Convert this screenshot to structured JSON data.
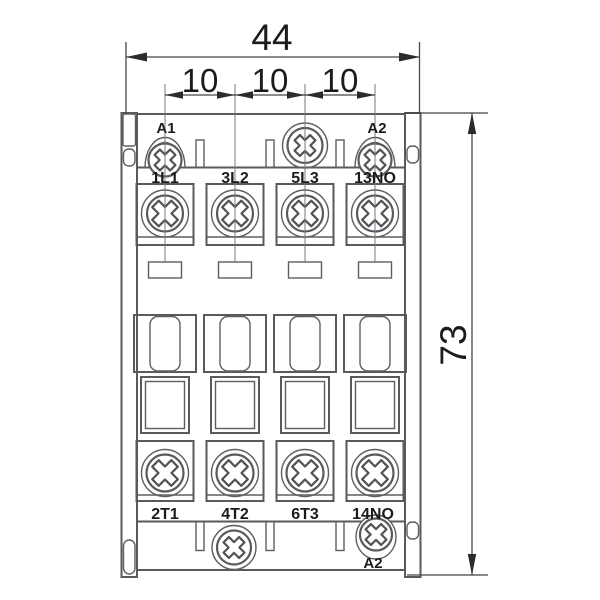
{
  "dimensions": {
    "total_width": "44",
    "pole_pitch": [
      "10",
      "10",
      "10"
    ],
    "total_height": "73"
  },
  "coil_labels": {
    "top_left": "A1",
    "top_right": "A2",
    "bottom_right": "A2"
  },
  "terminal_labels": {
    "top_row": [
      "1L1",
      "3L2",
      "5L3",
      "13NO"
    ],
    "bottom_row": [
      "2T1",
      "4T2",
      "6T3",
      "14NO"
    ]
  },
  "colors": {
    "background": "#ffffff",
    "body_line": "#595a5e",
    "dimension_line": "#46464a",
    "arrow_fill": "#2c2c2e",
    "label_text": "#1b1b1d"
  }
}
